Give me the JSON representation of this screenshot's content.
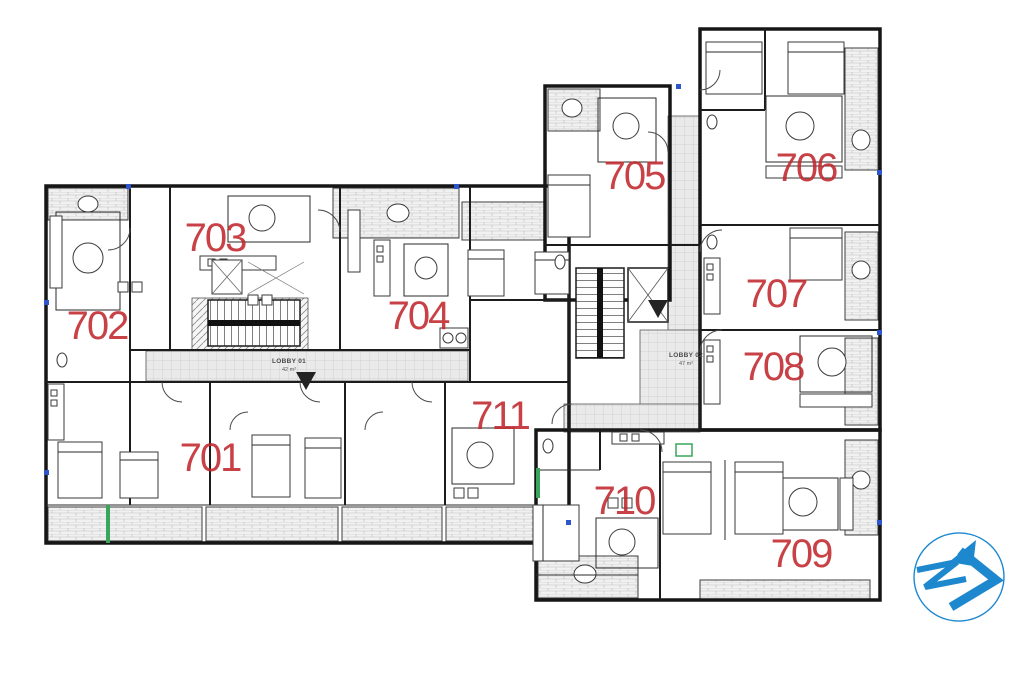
{
  "plan": {
    "type": "architectural-floor-plan",
    "units": [
      {
        "id": "701",
        "label": "701"
      },
      {
        "id": "702",
        "label": "702"
      },
      {
        "id": "703",
        "label": "703"
      },
      {
        "id": "704",
        "label": "704"
      },
      {
        "id": "705",
        "label": "705"
      },
      {
        "id": "706",
        "label": "706"
      },
      {
        "id": "707",
        "label": "707"
      },
      {
        "id": "708",
        "label": "708"
      },
      {
        "id": "709",
        "label": "709"
      },
      {
        "id": "710",
        "label": "710"
      },
      {
        "id": "711",
        "label": "711"
      }
    ],
    "lobbies": [
      {
        "name": "LOBBY 01",
        "area": "42 m²"
      },
      {
        "name": "LOBBY 02",
        "area": "47 m²"
      }
    ]
  },
  "colors": {
    "unit_label_red": "#c1272d",
    "wall_black": "#161616",
    "logo_blue": "#1e88cf",
    "floor_tile_gray": "#eaeaea"
  },
  "logo": {
    "icon": "z-arrow-logo"
  }
}
